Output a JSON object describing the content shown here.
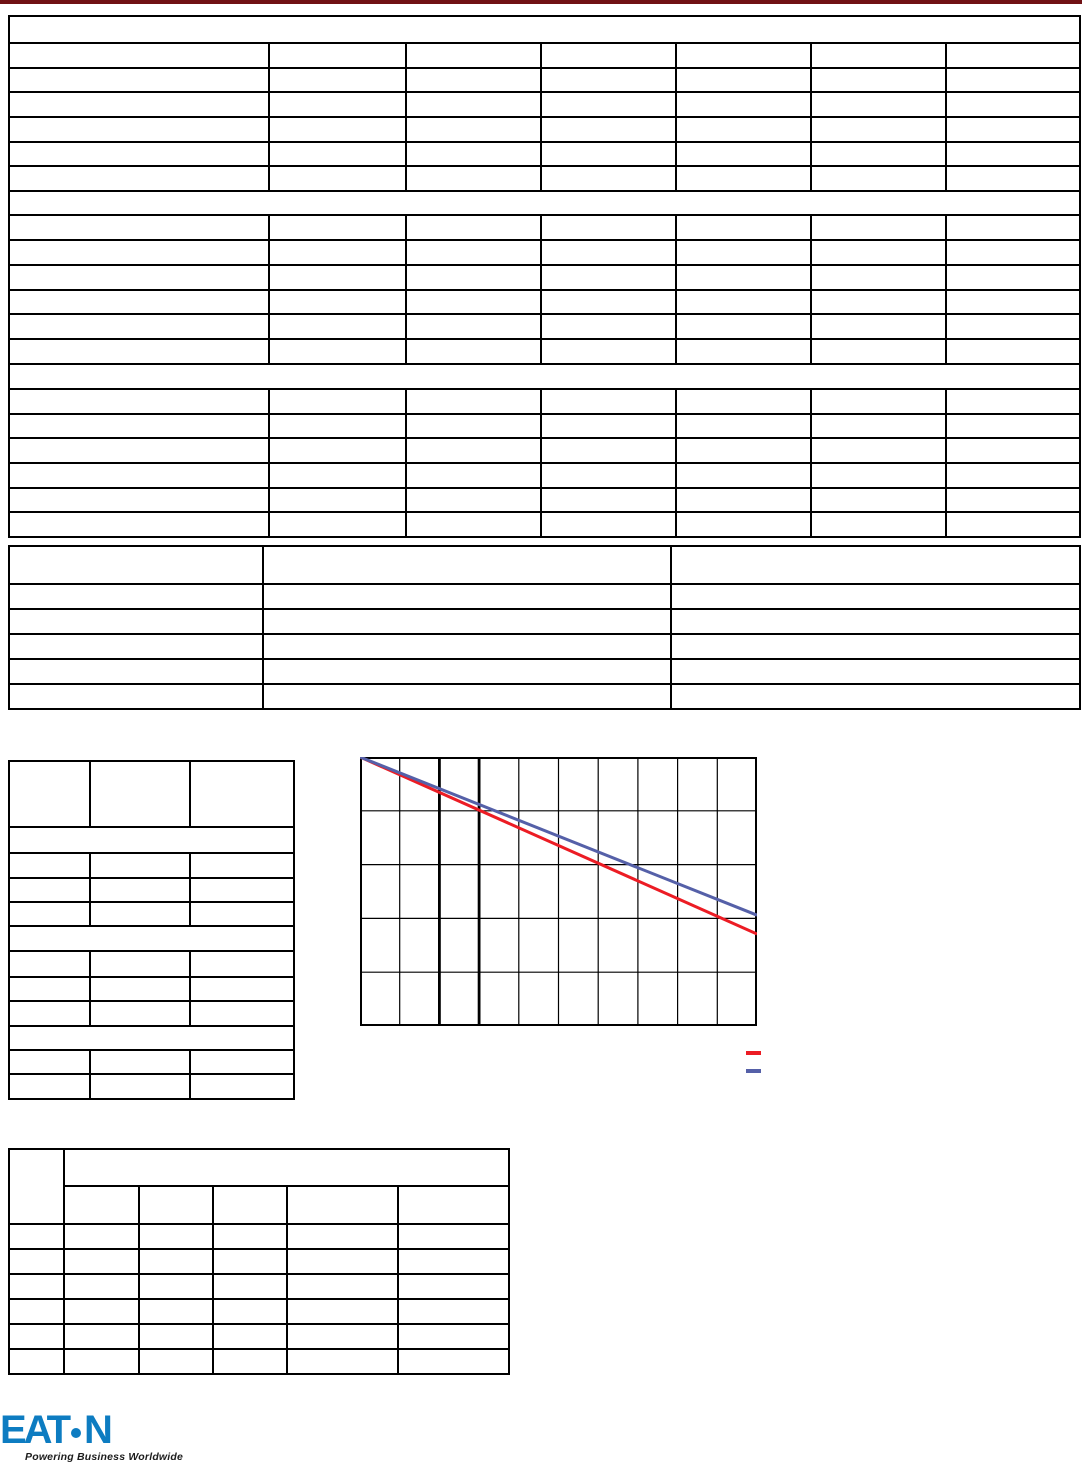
{
  "page": {
    "background_color": "#ffffff",
    "top_bar_color": "#701114",
    "table_line_color": "#000000"
  },
  "logo": {
    "wordmark_left": "EAT",
    "wordmark_right": "N",
    "wordmark_color": "#0d7cc1",
    "tagline": "Powering Business Worldwide",
    "tagline_color": "#1c1c1c"
  },
  "chart_data": {
    "type": "line",
    "title": "",
    "xlabel": "",
    "ylabel": "",
    "axis_tick_labels_visible": false,
    "grid": {
      "grid_on": true,
      "x_divisions": 10,
      "y_divisions": 5,
      "emphasized_x_gridline_indices": [
        2,
        3
      ],
      "xlim_grid_units": [
        0,
        10
      ],
      "ylim_grid_units": [
        0,
        5
      ]
    },
    "series": [
      {
        "name": "red-curve",
        "color": "#EC1C24",
        "stroke_width": 3,
        "points": [
          [
            0,
            5.0
          ],
          [
            10,
            1.71
          ]
        ]
      },
      {
        "name": "blue-curve",
        "color": "#5560A8",
        "stroke_width": 3,
        "points": [
          [
            0,
            5.0
          ],
          [
            10,
            2.06
          ]
        ]
      }
    ],
    "legend": {
      "position": "below-chart-right",
      "entries": [
        {
          "label": "",
          "swatch_color": "#EC1C24"
        },
        {
          "label": "",
          "swatch_color": "#5560A8"
        }
      ]
    }
  }
}
